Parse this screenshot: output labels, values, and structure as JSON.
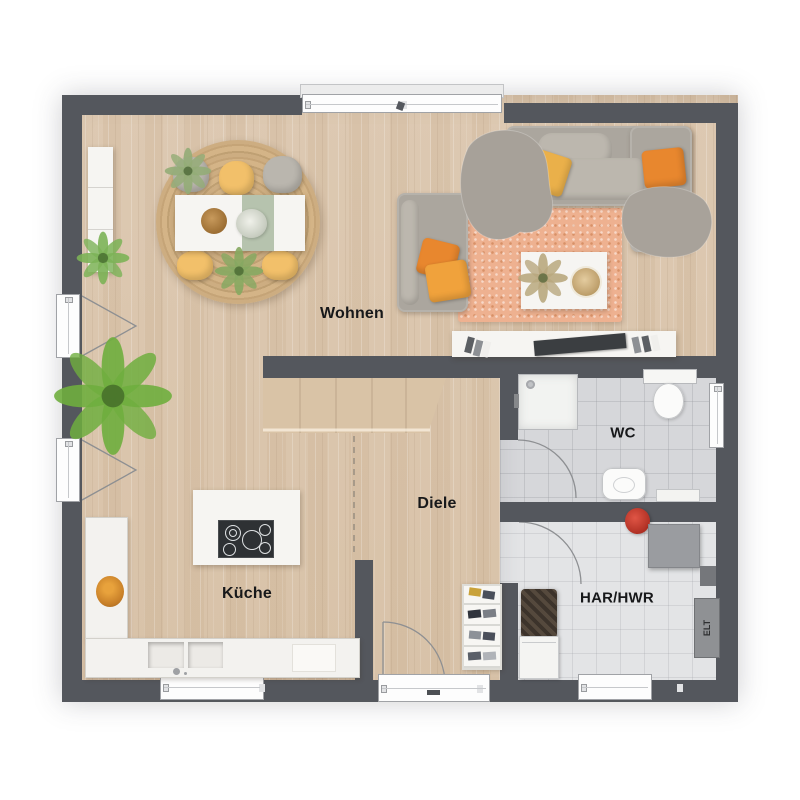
{
  "labels": {
    "wohnen": "Wohnen",
    "kueche": "Küche",
    "diele": "Diele",
    "wc": "WC",
    "har_hwr": "HAR/HWR",
    "elt": "ELT"
  },
  "palette": {
    "wall": "#54575d",
    "wood_floor": "#ddc9b2",
    "tile_wc": "#d6d7da",
    "tile_har": "#e3e4e6",
    "accent_orange": "#e8872e",
    "accent_yellow": "#f2c06a",
    "sofa_grey": "#aba69e",
    "rug_peach": "#eeb190",
    "rug_jute": "#c8a87c",
    "plant_green": "#6fae3e",
    "stairs_wood": "#d9c3a6"
  }
}
